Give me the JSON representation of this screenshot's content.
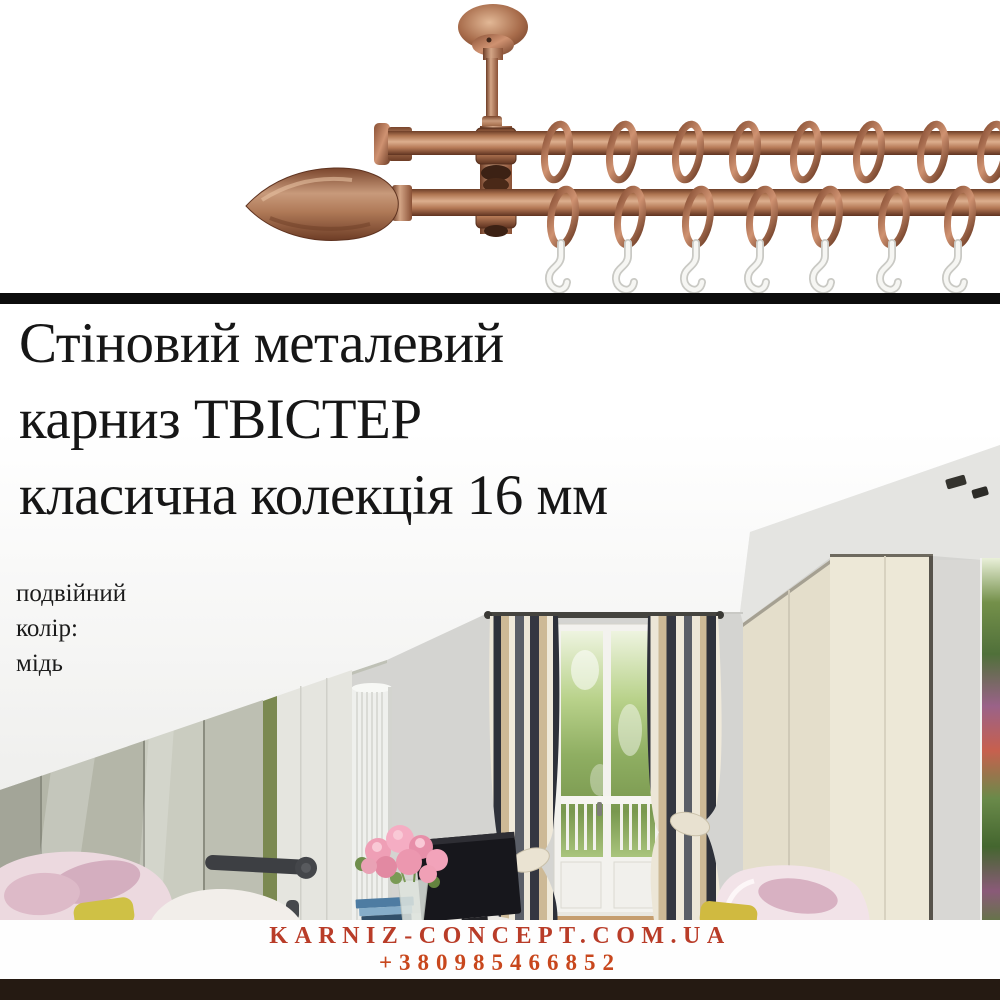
{
  "title": {
    "line1": "Стіновий металевий",
    "line2": "карниз ТВІСТЕР",
    "line3": "класична колекція 16 мм"
  },
  "specs": {
    "line1": "подвійний",
    "line2": "колір:",
    "line3": "мідь"
  },
  "footer": {
    "website": "KARNIZ-CONCEPT.COM.UA",
    "phone": "+380985466852"
  },
  "colors": {
    "copper_rod": "#b57956",
    "copper_highlight": "#dcae8e",
    "copper_shadow": "#5f3320",
    "divider_black": "#0c0c0c",
    "footer_bar_brown": "#251a12",
    "website_red": "#b93c28",
    "phone_orange_red": "#c8471d",
    "title_black": "#161616",
    "wall_grey": "#d4d4d1",
    "curtain_dark_stripe": "#2e313a",
    "curtain_tan_stripe": "#cdb996",
    "chair_pink": "#ecd9df",
    "pillow_yellow": "#cfc145"
  }
}
